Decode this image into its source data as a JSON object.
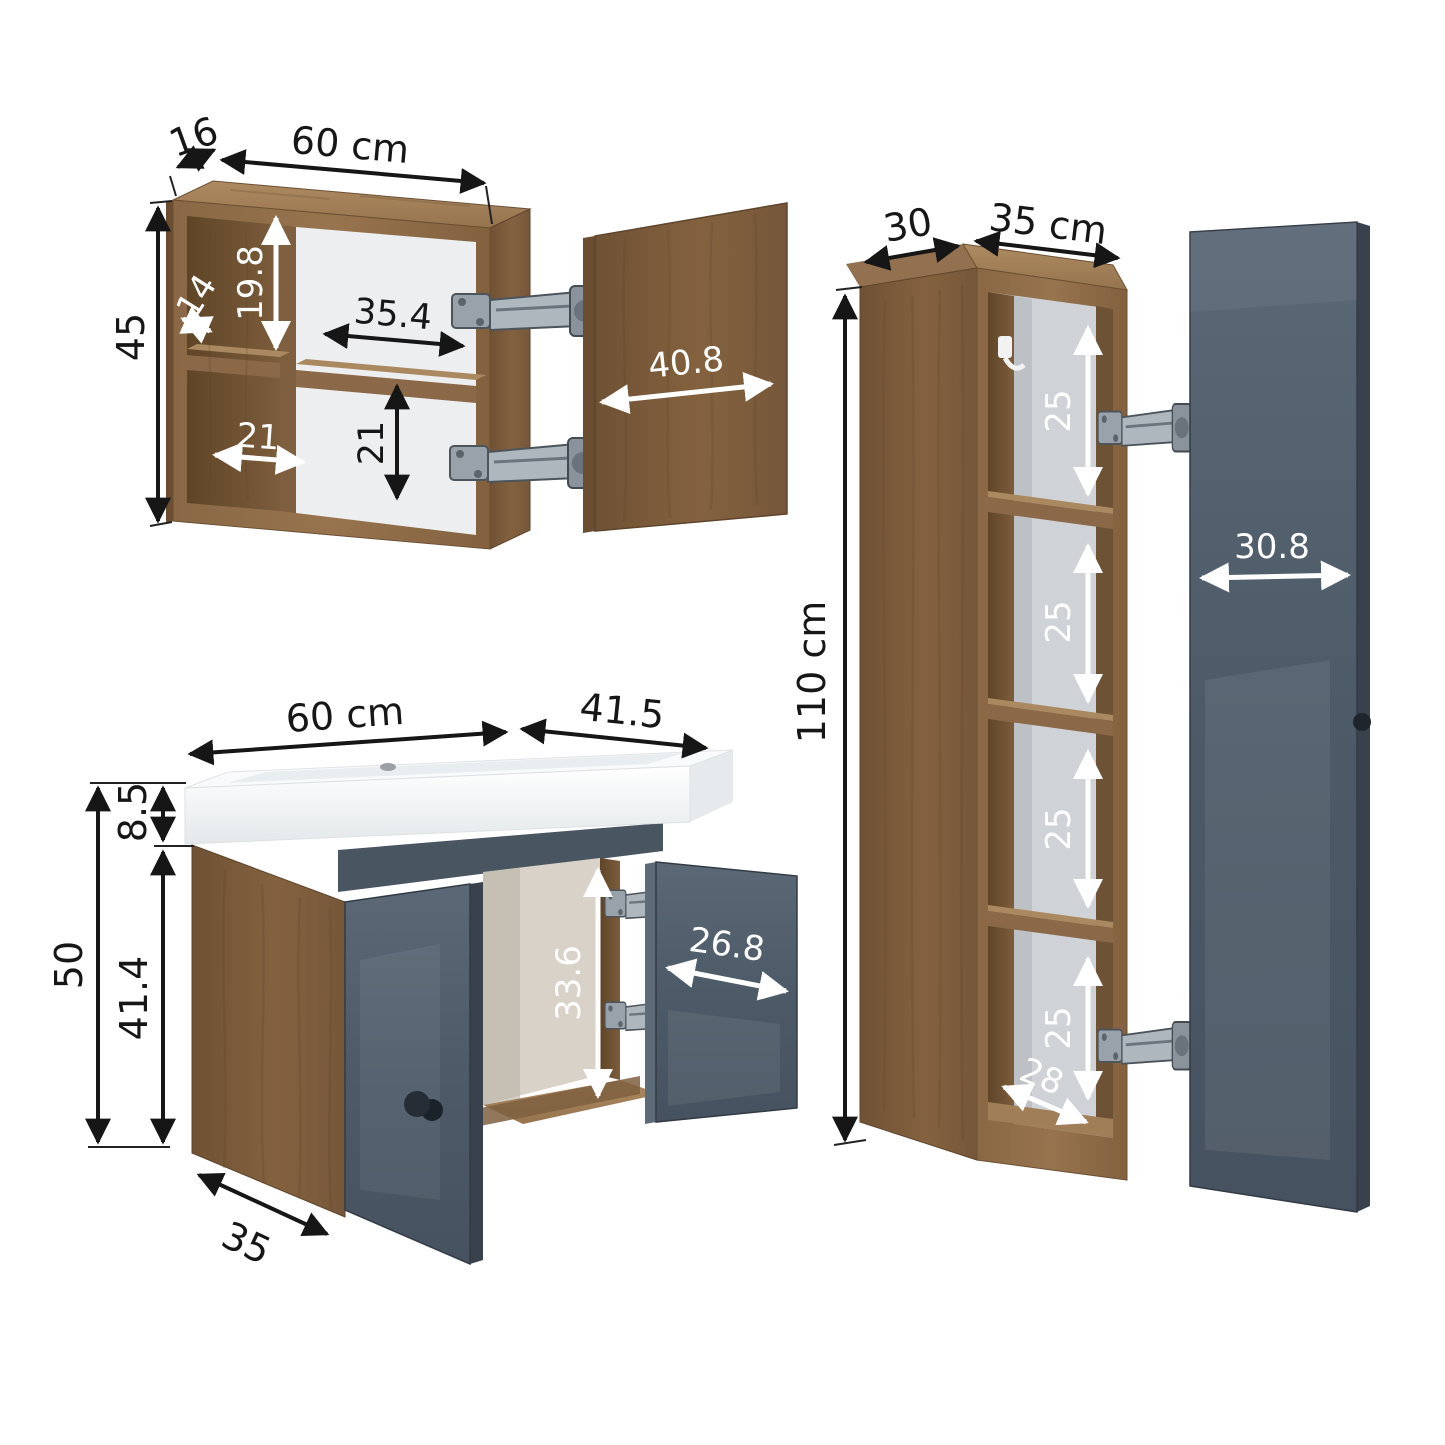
{
  "page": {
    "title": "Bathroom furniture set dimension diagram",
    "unit": "cm",
    "background": "#ffffff"
  },
  "colors": {
    "wood_front": "#8c6a47",
    "wood_side": "#7a5a3b",
    "wood_top": "#a07e58",
    "wood_interior": "#6e5236",
    "door_gray": "#4e5b69",
    "door_gray_dark": "#39424c",
    "apron_gray": "#4a5562",
    "sink_white": "#f8fafb",
    "back_panel": "#cfd3d7",
    "dimension_black": "#161616",
    "dimension_white": "#ffffff"
  },
  "mirror_cabinet": {
    "labels": {
      "depth": "16",
      "width": "60 cm",
      "height": "45",
      "inner_shelf_depth": "14",
      "upper_compartment_height": "19.8",
      "middle_compartment_width": "35.4",
      "door_width": "40.8",
      "lower_compartment_width": "21",
      "lower_compartment_height": "21"
    }
  },
  "vanity": {
    "labels": {
      "width": "60 cm",
      "sink_depth": "41.5",
      "sink_height": "8.5",
      "total_height": "50",
      "cabinet_height": "41.4",
      "interior_height": "33.6",
      "door_width": "26.8",
      "cabinet_depth": "35"
    }
  },
  "tall_cabinet": {
    "labels": {
      "depth": "30",
      "width": "35 cm",
      "height": "110 cm",
      "shelf_spacings": [
        "25",
        "25",
        "25",
        "25"
      ],
      "door_width": "30.8",
      "interior_depth": "28"
    }
  }
}
